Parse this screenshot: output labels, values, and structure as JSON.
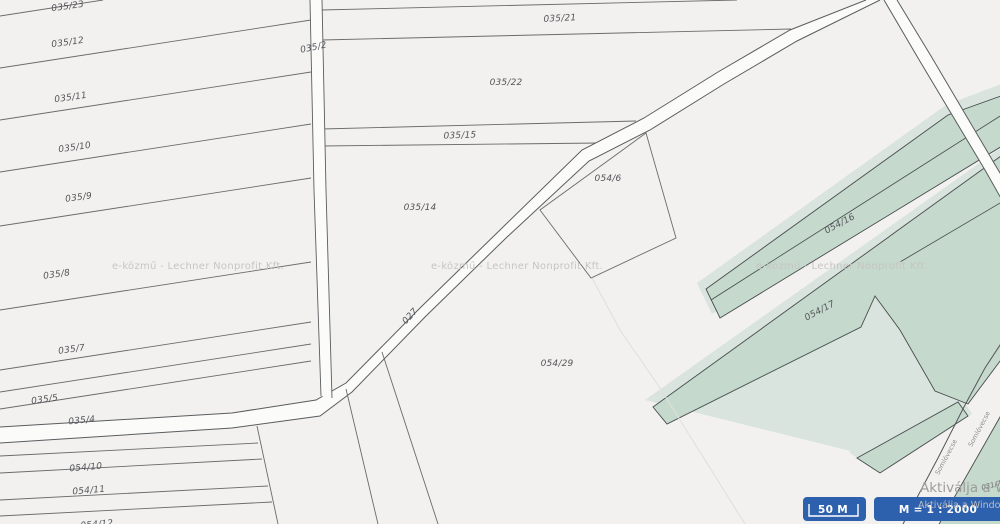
{
  "map": {
    "watermark": "e-közmű - Lechner Nonprofit Kft.",
    "parcel_labels": [
      {
        "text": "035/23"
      },
      {
        "text": "035/12"
      },
      {
        "text": "035/11"
      },
      {
        "text": "035/10"
      },
      {
        "text": "035/9"
      },
      {
        "text": "035/8"
      },
      {
        "text": "035/7"
      },
      {
        "text": "035/5"
      },
      {
        "text": "035/4"
      },
      {
        "text": "054/10"
      },
      {
        "text": "054/11"
      },
      {
        "text": "054/12"
      },
      {
        "text": "035/21"
      },
      {
        "text": "035/22"
      },
      {
        "text": "035/15"
      },
      {
        "text": "035/14"
      },
      {
        "text": "054/6"
      },
      {
        "text": "054/29"
      },
      {
        "text": "054/16"
      },
      {
        "text": "054/17"
      }
    ],
    "road_labels": [
      {
        "text": "035/2"
      },
      {
        "text": "027"
      }
    ],
    "street_labels": [
      {
        "text": "Somlóvecse"
      },
      {
        "text": "Somlóvecse"
      }
    ],
    "tiny_label": "031/7",
    "colors": {
      "background": "#f2f1ef",
      "parcel_line": "#66676b",
      "road_fill": "#fbfbfa",
      "green_parcel": "#c5d9cd",
      "green_pale": "#d8e4dd",
      "accent_blue": "#2e61ad"
    }
  },
  "windows_activation": {
    "line1": "Aktiválja a Windows",
    "line2": "Aktiválja a Windows"
  },
  "scale_bar": {
    "distance": "50 M",
    "ratio": "M = 1 : 2000"
  }
}
